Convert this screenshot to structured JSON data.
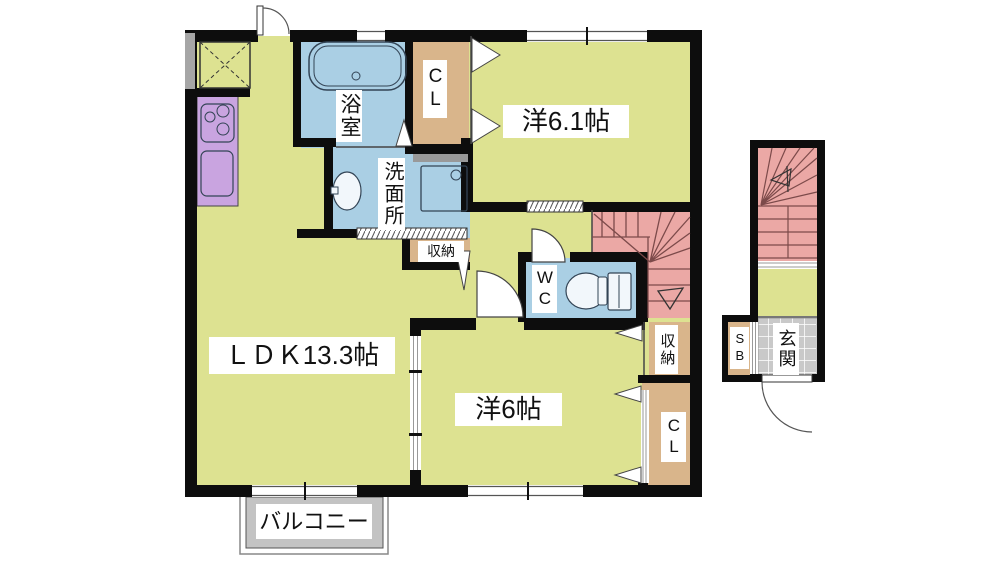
{
  "plan": {
    "type": "apartment-floor-plan",
    "labels": {
      "bathroom": "浴室",
      "washroom": "洗面所",
      "closet_upper": "CL",
      "western_room_upper": "洋6.1帖",
      "storage_hall": "収納",
      "wc": "WC",
      "storage_stairs": "収納",
      "closet_lower": "CL",
      "western_room_lower": "洋6帖",
      "ldk": "ＬＤＫ13.3帖",
      "balcony": "バルコニー",
      "shoe_box": "SB",
      "entrance": "玄関"
    },
    "colors": {
      "room_yellow": "#dde291",
      "water_blue": "#aacfe4",
      "closet_tan": "#d9b58b",
      "stairs_pink": "#eba8a5",
      "kitchen_purple": "#c9a4e0",
      "entrance_tile_gray": "#c9c9c9",
      "balcony_gray": "#c3c3c3",
      "wall_black": "#0d0d0d",
      "stair_line": "#7c4a4a"
    }
  }
}
